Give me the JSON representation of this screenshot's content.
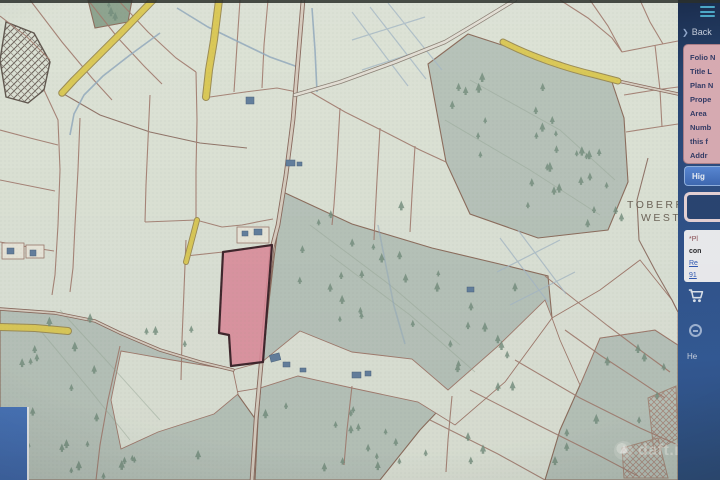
{
  "screen": {
    "map": {
      "townland": {
        "line1": "TOBERRO",
        "line2": "WEST"
      },
      "watermark_text": "daft.ie",
      "highlighted_parcel_color": "#e2879a",
      "road_color": "#ddc94b",
      "forest_color": "#b6c3b9",
      "field_color": "#dde3d6",
      "boundary_color": "#a3786a"
    },
    "sidebar": {
      "bg_color": "#2b4d86",
      "panel_color": "#d8aab2",
      "back_chevron": "❯",
      "back_label": "Back",
      "folio_panel": {
        "lines": [
          "Folio N",
          "Title L",
          "Plan N",
          "Prope",
          "Area",
          "Numb",
          "this f",
          "Addr"
        ]
      },
      "highlight_button_label": "Hig",
      "note_panel": {
        "line1": "*Pl",
        "line2": "con",
        "link1": "Re",
        "link2": "91"
      },
      "help_label": "He",
      "icons": [
        "hamburger-menu-icon",
        "chevron-right-icon",
        "cart-icon",
        "round-badge-icon"
      ]
    }
  }
}
